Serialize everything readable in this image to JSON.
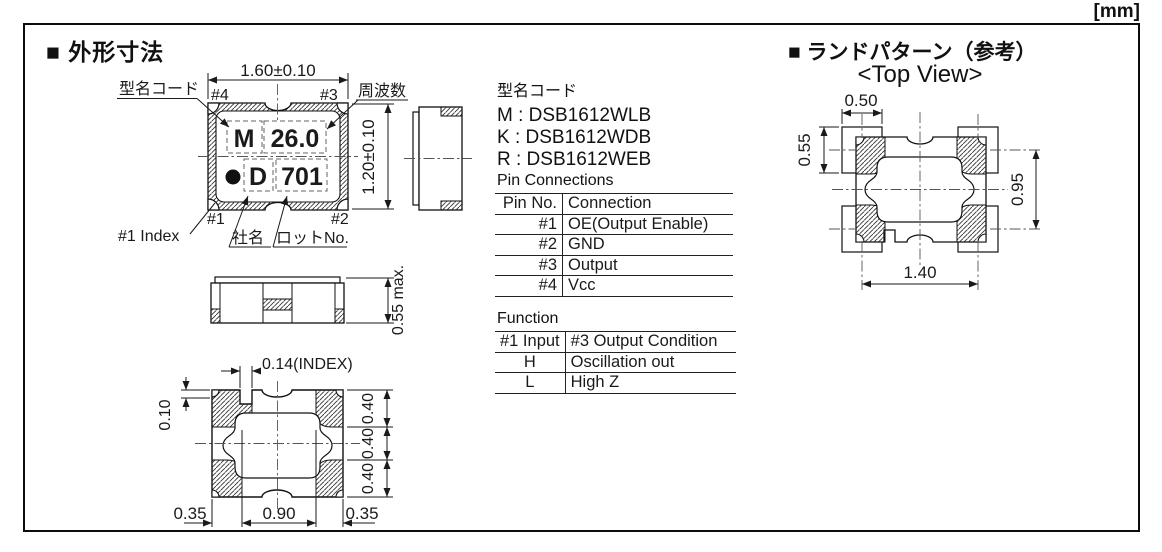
{
  "units_label": "[mm]",
  "outline_section": {
    "title": "■ 外形寸法",
    "package_top_view": {
      "dims": {
        "width": "1.60±0.10",
        "height": "1.20±0.10"
      },
      "pins": {
        "pin1": "#1",
        "pin2": "#2",
        "pin3": "#3",
        "pin4": "#4"
      },
      "marking": {
        "model_code": "M",
        "frequency": "26.0",
        "company": "D",
        "lot_no": "701"
      },
      "callouts": {
        "model_code": "型名コード",
        "frequency": "周波数",
        "index": "#1 Index",
        "company": "社名",
        "lot_no": "ロットNo."
      }
    },
    "front_view": {
      "dims": {
        "height": "0.55 max."
      }
    },
    "bottom_view": {
      "dims": {
        "index_width": "0.14(INDEX)",
        "index_depth": "0.10",
        "right": [
          "0.40",
          "0.40",
          "0.40"
        ],
        "bottom": [
          "0.35",
          "0.90",
          "0.35"
        ]
      }
    }
  },
  "model_codes": {
    "title": "型名コード",
    "items": [
      "M : DSB1612WLB",
      "K : DSB1612WDB",
      "R : DSB1612WEB"
    ]
  },
  "pin_connections": {
    "title": "Pin Connections",
    "headers": [
      "Pin No.",
      "Connection"
    ],
    "rows": [
      [
        "#1",
        "OE(Output Enable)"
      ],
      [
        "#2",
        "GND"
      ],
      [
        "#3",
        "Output"
      ],
      [
        "#4",
        "Vcc"
      ]
    ]
  },
  "function_table": {
    "title": "Function",
    "headers": [
      "#1 Input",
      "#3 Output Condition"
    ],
    "rows": [
      [
        "H",
        "Oscillation out"
      ],
      [
        "L",
        "High Z"
      ]
    ]
  },
  "land_pattern_section": {
    "title": "■ ランドパターン（参考）",
    "subtitle": "<Top View>",
    "dims": {
      "pad_width": "0.50",
      "pad_height": "0.55",
      "vertical_pitch": "0.95",
      "horizontal_pitch": "1.40"
    }
  }
}
